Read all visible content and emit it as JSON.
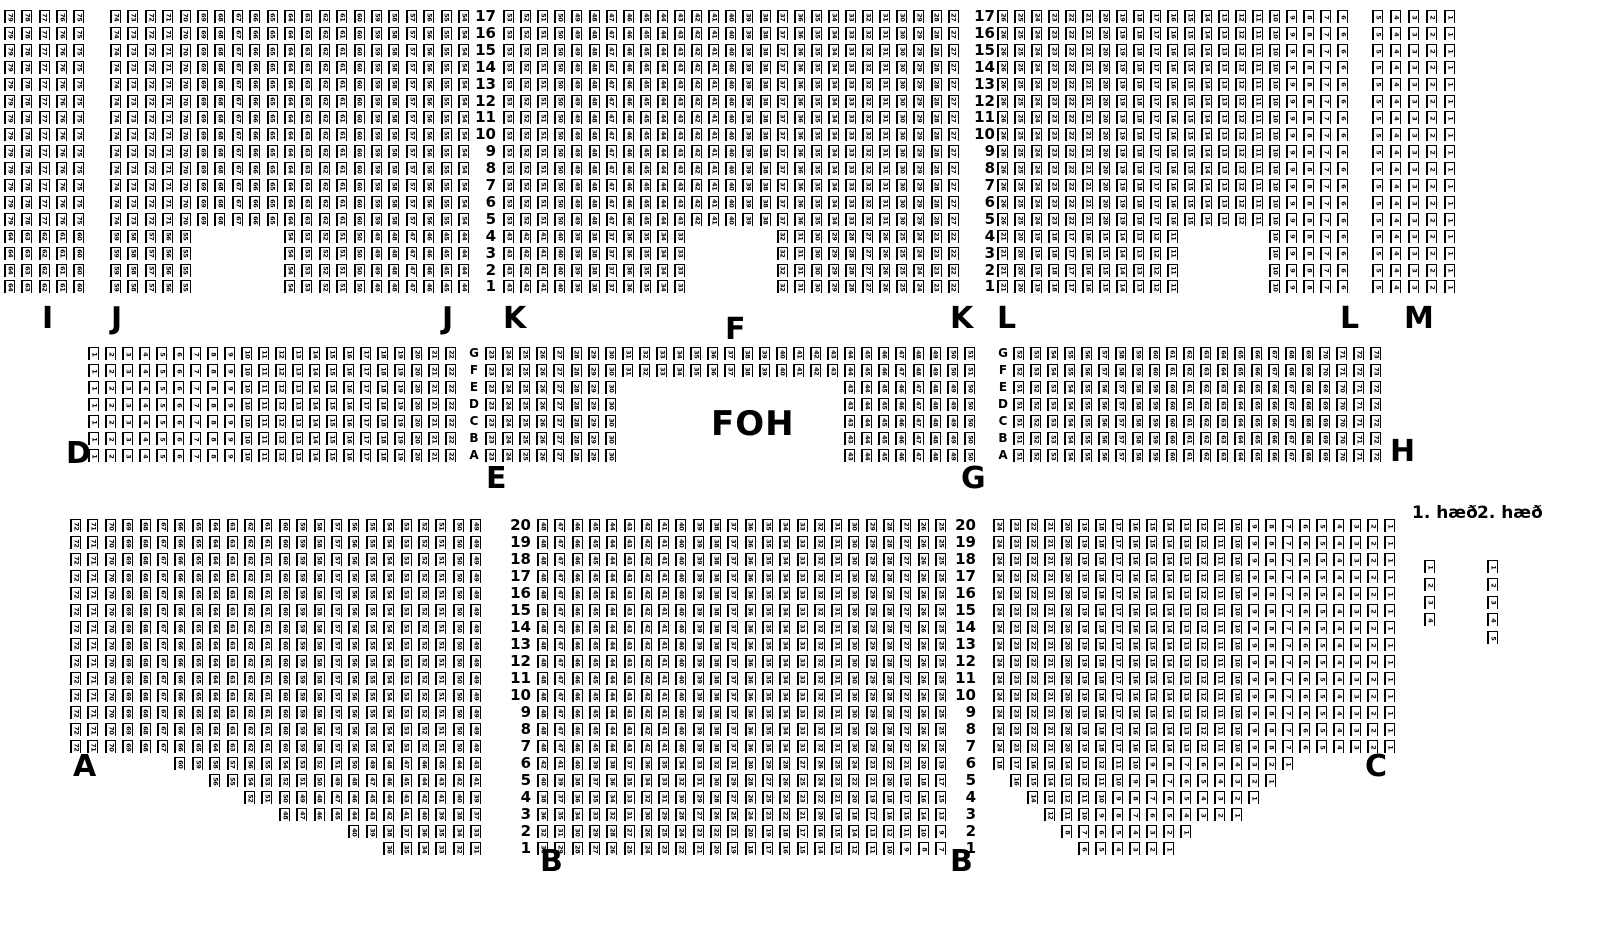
{
  "colors": {
    "ink": "#000000",
    "background": "#ffffff"
  },
  "foh": {
    "label": "FOH"
  },
  "legend": {
    "floor1": "1. hæð",
    "floor2": "2. hæð"
  },
  "seatmap": {
    "seat_size": {
      "w": 11,
      "h": 13
    },
    "sections": [
      {
        "name": "I",
        "x": 4,
        "y": 10,
        "px": 17.3,
        "py": 16.9,
        "rows": [
          {
            "repeat": 13,
            "segs": [
              [
                1,
                5,
                79,
                -1
              ]
            ]
          },
          {
            "repeat": 4,
            "segs": [
              [
                1,
                5,
                64,
                -1
              ]
            ]
          }
        ]
      },
      {
        "name": "J",
        "x": 110,
        "y": 10,
        "px": 17.4,
        "py": 16.9,
        "rows": [
          {
            "repeat": 13,
            "segs": [
              [
                1,
                21,
                74,
                -1
              ]
            ]
          },
          {
            "repeat": 4,
            "segs": [
              [
                1,
                5,
                59,
                -1
              ],
              [
                11,
                11,
                54,
                -1
              ]
            ]
          }
        ]
      },
      {
        "name": "K",
        "x": 503,
        "y": 10,
        "px": 17.1,
        "py": 16.9,
        "rows": [
          {
            "repeat": 13,
            "segs": [
              [
                1,
                27,
                53,
                -1
              ]
            ]
          },
          {
            "repeat": 4,
            "segs": [
              [
                1,
                11,
                43,
                -1
              ],
              [
                17,
                11,
                32,
                -1
              ]
            ]
          }
        ]
      },
      {
        "name": "L",
        "x": 997,
        "y": 10,
        "px": 17.0,
        "py": 16.9,
        "rows": [
          {
            "repeat": 13,
            "segs": [
              [
                1,
                21,
                26,
                -1
              ]
            ]
          },
          {
            "repeat": 4,
            "segs": [
              [
                1,
                11,
                21,
                -1
              ],
              [
                17,
                5,
                10,
                -1
              ]
            ]
          }
        ]
      },
      {
        "name": "M",
        "x": 1372,
        "y": 10,
        "px": 18.0,
        "py": 16.9,
        "rows": [
          {
            "repeat": 17,
            "segs": [
              [
                1,
                5,
                5,
                -1
              ]
            ]
          }
        ]
      },
      {
        "name": "D",
        "x": 88,
        "y": 347,
        "px": 17.0,
        "py": 17.0,
        "rows": [
          {
            "repeat": 7,
            "segs": [
              [
                1,
                22,
                1,
                1
              ]
            ]
          }
        ]
      },
      {
        "name": "EFG",
        "x": 485,
        "y": 347,
        "px": 17.1,
        "py": 17.0,
        "rows": [
          {
            "repeat": 2,
            "segs": [
              [
                1,
                29,
                23,
                1
              ]
            ]
          },
          {
            "repeat": 5,
            "segs": [
              [
                1,
                8,
                23,
                1
              ],
              [
                22,
                8,
                43,
                1
              ]
            ]
          }
        ]
      },
      {
        "name": "H",
        "x": 1013,
        "y": 347,
        "px": 17.0,
        "py": 17.0,
        "rows": [
          {
            "repeat": 2,
            "segs": [
              [
                1,
                22,
                52,
                1
              ]
            ]
          },
          {
            "repeat": 5,
            "segs": [
              [
                1,
                22,
                51,
                1
              ]
            ]
          }
        ]
      },
      {
        "name": "A",
        "x": 70,
        "y": 519,
        "px": 17.4,
        "py": 17.0,
        "rows": [
          {
            "repeat": 14,
            "segs": [
              [
                1,
                24,
                72,
                -1
              ]
            ]
          },
          {
            "segs": [
              [
                7,
                18,
                60,
                -1
              ]
            ]
          },
          {
            "segs": [
              [
                9,
                16,
                56,
                -1
              ]
            ]
          },
          {
            "segs": [
              [
                11,
                14,
                52,
                -1
              ]
            ]
          },
          {
            "segs": [
              [
                13,
                12,
                48,
                -1
              ]
            ]
          },
          {
            "segs": [
              [
                17,
                8,
                40,
                -1
              ]
            ]
          },
          {
            "segs": [
              [
                19,
                6,
                36,
                -1
              ]
            ]
          }
        ]
      },
      {
        "name": "B",
        "x": 537,
        "y": 519,
        "px": 17.3,
        "py": 17.0,
        "rows": [
          {
            "repeat": 14,
            "segs": [
              [
                1,
                24,
                48,
                -1
              ]
            ]
          },
          {
            "segs": [
              [
                1,
                24,
                42,
                -1
              ]
            ]
          },
          {
            "segs": [
              [
                1,
                24,
                40,
                -1
              ]
            ]
          },
          {
            "segs": [
              [
                1,
                24,
                38,
                -1
              ]
            ]
          },
          {
            "segs": [
              [
                1,
                24,
                36,
                -1
              ]
            ]
          },
          {
            "segs": [
              [
                1,
                24,
                32,
                -1
              ]
            ]
          },
          {
            "segs": [
              [
                1,
                24,
                30,
                -1
              ]
            ]
          }
        ]
      },
      {
        "name": "C",
        "x": 993,
        "y": 519,
        "px": 17.0,
        "py": 17.0,
        "rows": [
          {
            "repeat": 14,
            "segs": [
              [
                1,
                24,
                24,
                -1
              ]
            ]
          },
          {
            "segs": [
              [
                1,
                18,
                18,
                -1
              ]
            ]
          },
          {
            "segs": [
              [
                2,
                16,
                16,
                -1
              ]
            ]
          },
          {
            "segs": [
              [
                3,
                14,
                14,
                -1
              ]
            ]
          },
          {
            "segs": [
              [
                4,
                12,
                12,
                -1
              ]
            ]
          },
          {
            "segs": [
              [
                5,
                8,
                8,
                -1
              ]
            ]
          },
          {
            "segs": [
              [
                6,
                6,
                6,
                -1
              ]
            ]
          }
        ]
      },
      {
        "name": "floor1-strip",
        "x": 1424,
        "y": 560,
        "px": 17.0,
        "py": 17.8,
        "rows": [
          {
            "segs": [
              [
                1,
                1,
                1,
                1
              ]
            ]
          },
          {
            "segs": [
              [
                1,
                1,
                2,
                1
              ]
            ]
          },
          {
            "segs": [
              [
                1,
                1,
                3,
                1
              ]
            ]
          },
          {
            "segs": [
              [
                1,
                1,
                4,
                1
              ]
            ]
          }
        ]
      },
      {
        "name": "floor2-strip",
        "x": 1487,
        "y": 560,
        "px": 17.0,
        "py": 17.8,
        "rows": [
          {
            "segs": [
              [
                1,
                1,
                1,
                1
              ]
            ]
          },
          {
            "segs": [
              [
                1,
                1,
                2,
                1
              ]
            ]
          },
          {
            "segs": [
              [
                1,
                1,
                3,
                1
              ]
            ]
          },
          {
            "segs": [
              [
                1,
                1,
                4,
                1
              ]
            ]
          },
          {
            "segs": [
              [
                1,
                1,
                5,
                1
              ]
            ]
          }
        ]
      }
    ],
    "label_columns": [
      {
        "name": "row-numbers-top-left",
        "x": 472,
        "y": 10,
        "py": 16.9,
        "w": 24,
        "align": "right",
        "font": 15,
        "labels": [
          "17",
          "16",
          "15",
          "14",
          "13",
          "12",
          "11",
          "10",
          "9",
          "8",
          "7",
          "6",
          "5",
          "4",
          "3",
          "2",
          "1"
        ]
      },
      {
        "name": "row-numbers-top-right",
        "x": 971,
        "y": 10,
        "py": 16.9,
        "w": 24,
        "align": "right",
        "font": 15,
        "labels": [
          "17",
          "16",
          "15",
          "14",
          "13",
          "12",
          "11",
          "10",
          "9",
          "8",
          "7",
          "6",
          "5",
          "4",
          "3",
          "2",
          "1"
        ]
      },
      {
        "name": "row-letters-left",
        "x": 466,
        "y": 347,
        "py": 17.0,
        "w": 16,
        "align": "center",
        "font": 12,
        "labels": [
          "G",
          "F",
          "E",
          "D",
          "C",
          "B",
          "A"
        ]
      },
      {
        "name": "row-letters-right",
        "x": 995,
        "y": 347,
        "py": 17.0,
        "w": 16,
        "align": "center",
        "font": 12,
        "labels": [
          "G",
          "F",
          "E",
          "D",
          "C",
          "B",
          "A"
        ]
      },
      {
        "name": "row-numbers-bottom-left",
        "x": 507,
        "y": 519,
        "py": 17.0,
        "w": 24,
        "align": "right",
        "font": 15,
        "labels": [
          "20",
          "19",
          "18",
          "17",
          "16",
          "15",
          "14",
          "13",
          "12",
          "11",
          "10",
          "9",
          "8",
          "7",
          "6",
          "5",
          "4",
          "3",
          "2",
          "1"
        ]
      },
      {
        "name": "row-numbers-bottom-right",
        "x": 952,
        "y": 519,
        "py": 17.0,
        "w": 24,
        "align": "right",
        "font": 15,
        "labels": [
          "20",
          "19",
          "18",
          "17",
          "16",
          "15",
          "14",
          "13",
          "12",
          "11",
          "10",
          "9",
          "8",
          "7",
          "6",
          "5",
          "4",
          "3",
          "2",
          "1"
        ]
      }
    ],
    "section_labels": [
      {
        "t": "I",
        "x": 42,
        "y": 304
      },
      {
        "t": "J",
        "x": 111,
        "y": 304
      },
      {
        "t": "J",
        "x": 442,
        "y": 304
      },
      {
        "t": "K",
        "x": 503,
        "y": 304
      },
      {
        "t": "K",
        "x": 950,
        "y": 304
      },
      {
        "t": "L",
        "x": 997,
        "y": 304
      },
      {
        "t": "L",
        "x": 1340,
        "y": 304
      },
      {
        "t": "M",
        "x": 1404,
        "y": 304
      },
      {
        "t": "F",
        "x": 725,
        "y": 315
      },
      {
        "t": "D",
        "x": 66,
        "y": 439
      },
      {
        "t": "H",
        "x": 1390,
        "y": 437
      },
      {
        "t": "E",
        "x": 486,
        "y": 464
      },
      {
        "t": "G",
        "x": 961,
        "y": 464
      },
      {
        "t": "A",
        "x": 73,
        "y": 752
      },
      {
        "t": "C",
        "x": 1365,
        "y": 752
      },
      {
        "t": "B",
        "x": 540,
        "y": 847
      },
      {
        "t": "B",
        "x": 950,
        "y": 847
      }
    ]
  }
}
